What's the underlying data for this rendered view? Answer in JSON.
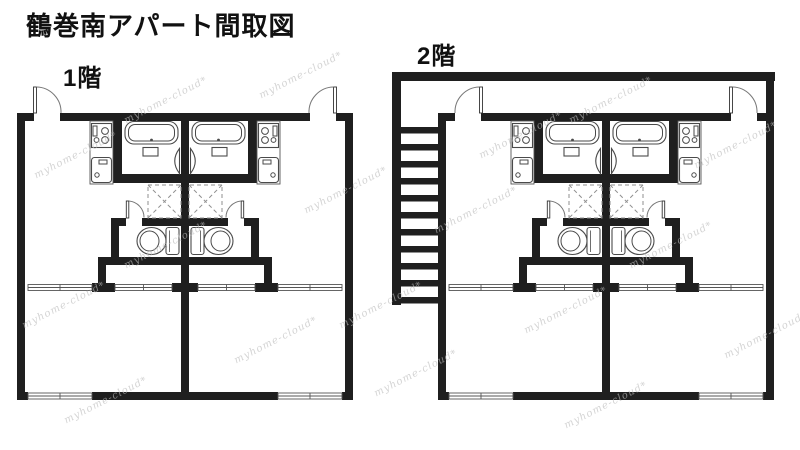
{
  "title": "鶴巻南アパート間取図",
  "floors": [
    {
      "label": "1階"
    },
    {
      "label": "2階"
    }
  ],
  "watermark": {
    "text": "myhome-cloud*"
  },
  "colors": {
    "background": "#ffffff",
    "wall": "#1f1f1f",
    "fixture_line": "#4a4a4a",
    "dashed_line": "#8f8f8f",
    "watermark": "#bdbdbd",
    "text": "#111111"
  },
  "fixtures": [
    "bathtub-icon",
    "stove-icon",
    "kitchen-sink-icon",
    "toilet-icon",
    "washer-space-icon",
    "entrance-door-icon",
    "toilet-door-icon",
    "bath-door-icon",
    "sliding-window-icon",
    "staircase-icon"
  ]
}
